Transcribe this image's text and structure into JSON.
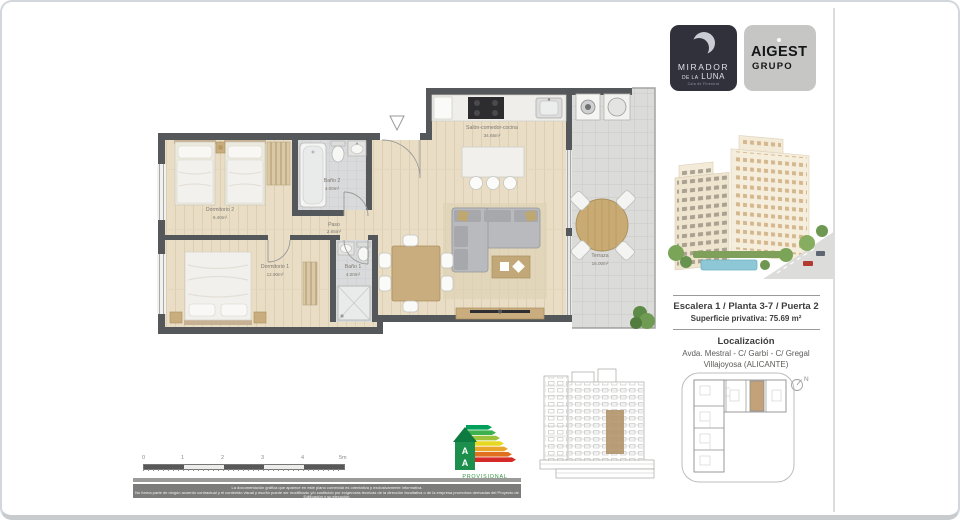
{
  "brand": {
    "mirador": {
      "name_line1": "MIRADOR",
      "name_line2_small": "DE LA",
      "name_line2_big": "LUNA",
      "tagline": "Cala de Finestrat"
    },
    "aigest": {
      "name_line1": "AIGEST",
      "name_line2": "GRUPO"
    }
  },
  "info": {
    "unit_title": "Escalera 1 / Planta 3-7 / Puerta 2",
    "surface": "Superficie privativa: 75.69 m²",
    "location_heading": "Localización",
    "location_line1": "Avda. Mestral - C/ Garbí - C/ Gregal",
    "location_line2": "Villajoyosa (ALICANTE)"
  },
  "floorplan": {
    "rooms": [
      {
        "name": "Dormitorio 2",
        "area": "9.40m²"
      },
      {
        "name": "Baño 2",
        "area": "4.00m²"
      },
      {
        "name": "Paso",
        "area": "2.65m²"
      },
      {
        "name": "Salón-comedor-cocina",
        "area": "34.65m²"
      },
      {
        "name": "Dormitorio 1",
        "area": "12.90m²"
      },
      {
        "name": "Baño 1",
        "area": "4.00m²"
      },
      {
        "name": "Terraza",
        "area": "16.00m²"
      }
    ]
  },
  "scalebar": {
    "ticks": [
      "0",
      "1",
      "2",
      "3",
      "4",
      "5m"
    ]
  },
  "energy": {
    "rating": "A",
    "status": "PROVISIONAL"
  },
  "siteplan": {
    "north_label": "N"
  },
  "disclaimer": {
    "line1": "La documentación gráfica que aparece en este plano comercial es orientativa y exclusivamente informativa.",
    "line2": "No forma parte de ningún acuerdo contractual y el contenido visual y escrito puede ser modificado y/o sustituido por exigencias técnicas de la dirección facultativa o de la empresa promotora derivadas del Proyecto de Edificación y su ejecución."
  },
  "colors": {
    "wall": "#55585b",
    "wood": "#e9ddc6",
    "highlight_tan": "#b3946a",
    "energy_green": "#35953f"
  }
}
